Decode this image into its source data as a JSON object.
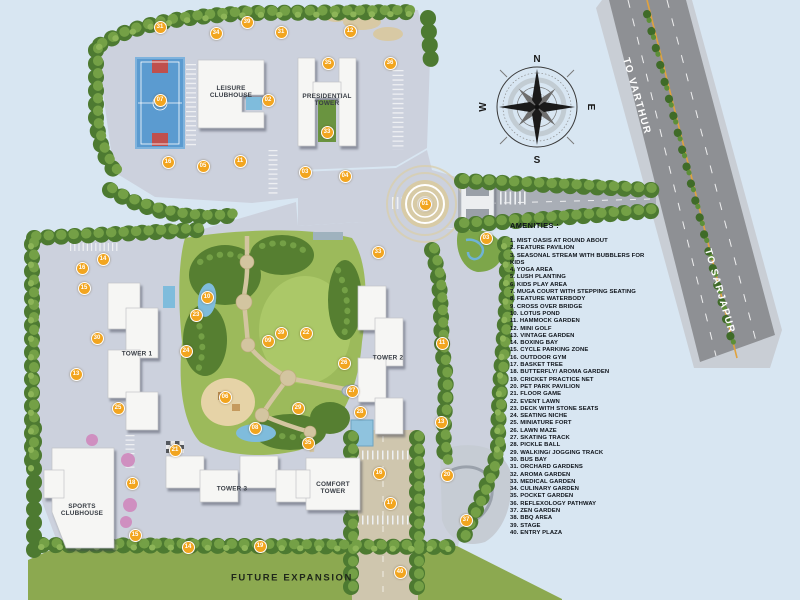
{
  "legend": {
    "title": "AMENITIES :",
    "items": [
      "1. MIST OASIS AT ROUND ABOUT",
      "2. FEATURE PAVILION",
      "3. SEASONAL STREAM WITH BUBBLERS FOR KIDS",
      "4. YOGA AREA",
      "5. LUSH PLANTING",
      "6. KIDS PLAY AREA",
      "7. MUGA COURT WITH STEPPING SEATING",
      "8. FEATURE WATERBODY",
      "9. CROSS OVER BRIDGE",
      "10. LOTUS POND",
      "11. HAMMOCK GARDEN",
      "12. MINI GOLF",
      "13. VINTAGE GARDEN",
      "14. BOXING BAY",
      "15. CYCLE PARKING ZONE",
      "16. OUTDOOR GYM",
      "17. BASKET TREE",
      "18. BUTTERFLY/ AROMA GARDEN",
      "19. CRICKET PRACTICE NET",
      "20. PET PARK PAVILION",
      "21. FLOOR GAME",
      "22. EVENT LAWN",
      "23. DECK WITH STONE SEATS",
      "24. SEATING NICHE",
      "25. MINIATURE FORT",
      "26. LAWN MAZE",
      "27. SKATING TRACK",
      "28. PICKLE BALL",
      "29. WALKING/ JOGGING TRACK",
      "30. BUS BAY",
      "31. ORCHARD GARDENS",
      "32. AROMA GARDEN",
      "33. MEDICAL GARDEN",
      "34. CULINARY GARDEN",
      "35. POCKET GARDEN",
      "36. REFLEXOLOGY PATHWAY",
      "37. ZEN GARDEN",
      "38. BBQ AREA",
      "39. STAGE",
      "40. ENTRY PLAZA"
    ]
  },
  "roads": {
    "north_label": "TO VARTHUR",
    "south_label": "TO SARJAPUR"
  },
  "compass": {
    "n": "N",
    "e": "E",
    "s": "S",
    "w": "W"
  },
  "buildings": {
    "leisure": {
      "l1": "LEISURE",
      "l2": "CLUBHOUSE"
    },
    "presidential": {
      "l1": "PRESIDENTIAL",
      "l2": "TOWER"
    },
    "tower1": {
      "l1": "TOWER 1"
    },
    "tower2": {
      "l1": "TOWER 2"
    },
    "tower3": {
      "l1": "TOWER 3"
    },
    "comfort": {
      "l1": "COMFORT",
      "l2": "TOWER"
    },
    "sports": {
      "l1": "SPORTS",
      "l2": "CLUBHOUSE"
    }
  },
  "future_expansion_label": "FUTURE EXPANSION",
  "markers": [
    {
      "n": "31",
      "x": 160,
      "y": 27
    },
    {
      "n": "34",
      "x": 216,
      "y": 33
    },
    {
      "n": "39",
      "x": 247,
      "y": 22
    },
    {
      "n": "31",
      "x": 281,
      "y": 32
    },
    {
      "n": "12",
      "x": 350,
      "y": 31
    },
    {
      "n": "35",
      "x": 328,
      "y": 63
    },
    {
      "n": "36",
      "x": 390,
      "y": 63
    },
    {
      "n": "07",
      "x": 160,
      "y": 100
    },
    {
      "n": "02",
      "x": 268,
      "y": 100
    },
    {
      "n": "33",
      "x": 327,
      "y": 132
    },
    {
      "n": "16",
      "x": 168,
      "y": 162
    },
    {
      "n": "05",
      "x": 203,
      "y": 166
    },
    {
      "n": "11",
      "x": 240,
      "y": 161
    },
    {
      "n": "03",
      "x": 305,
      "y": 172
    },
    {
      "n": "04",
      "x": 345,
      "y": 176
    },
    {
      "n": "01",
      "x": 425,
      "y": 204
    },
    {
      "n": "03",
      "x": 486,
      "y": 238
    },
    {
      "n": "14",
      "x": 103,
      "y": 259
    },
    {
      "n": "16",
      "x": 82,
      "y": 268
    },
    {
      "n": "15",
      "x": 84,
      "y": 288
    },
    {
      "n": "30",
      "x": 97,
      "y": 338
    },
    {
      "n": "13",
      "x": 76,
      "y": 374
    },
    {
      "n": "25",
      "x": 118,
      "y": 408
    },
    {
      "n": "10",
      "x": 207,
      "y": 297
    },
    {
      "n": "23",
      "x": 196,
      "y": 315
    },
    {
      "n": "24",
      "x": 186,
      "y": 351
    },
    {
      "n": "39",
      "x": 281,
      "y": 333
    },
    {
      "n": "22",
      "x": 306,
      "y": 333
    },
    {
      "n": "09",
      "x": 268,
      "y": 341
    },
    {
      "n": "26",
      "x": 344,
      "y": 363
    },
    {
      "n": "27",
      "x": 352,
      "y": 391
    },
    {
      "n": "06",
      "x": 225,
      "y": 397
    },
    {
      "n": "29",
      "x": 298,
      "y": 408
    },
    {
      "n": "28",
      "x": 360,
      "y": 412
    },
    {
      "n": "08",
      "x": 255,
      "y": 428
    },
    {
      "n": "33",
      "x": 378,
      "y": 252
    },
    {
      "n": "11",
      "x": 442,
      "y": 343
    },
    {
      "n": "13",
      "x": 441,
      "y": 422
    },
    {
      "n": "21",
      "x": 175,
      "y": 450
    },
    {
      "n": "18",
      "x": 132,
      "y": 483
    },
    {
      "n": "15",
      "x": 135,
      "y": 535
    },
    {
      "n": "14",
      "x": 188,
      "y": 547
    },
    {
      "n": "19",
      "x": 260,
      "y": 546
    },
    {
      "n": "35",
      "x": 308,
      "y": 443
    },
    {
      "n": "16",
      "x": 379,
      "y": 473
    },
    {
      "n": "17",
      "x": 390,
      "y": 503
    },
    {
      "n": "20",
      "x": 447,
      "y": 475
    },
    {
      "n": "37",
      "x": 466,
      "y": 520
    },
    {
      "n": "40",
      "x": 400,
      "y": 572
    }
  ],
  "colors": {
    "background": "#d8e6f2",
    "road": "#8e9094",
    "road_median_line": "#e0a23e",
    "hardscape": "#ccd1dd",
    "path_tan": "#d3c5a0",
    "tree_dark": "#4d7a31",
    "tree_light": "#74a046",
    "lawn": "#8ca950",
    "park_lawn": "#a9c765",
    "building": "#f6f6f4",
    "court_blue": "#5b9bd0",
    "water": "#7fbcdc",
    "marker": "#f2a51f"
  }
}
